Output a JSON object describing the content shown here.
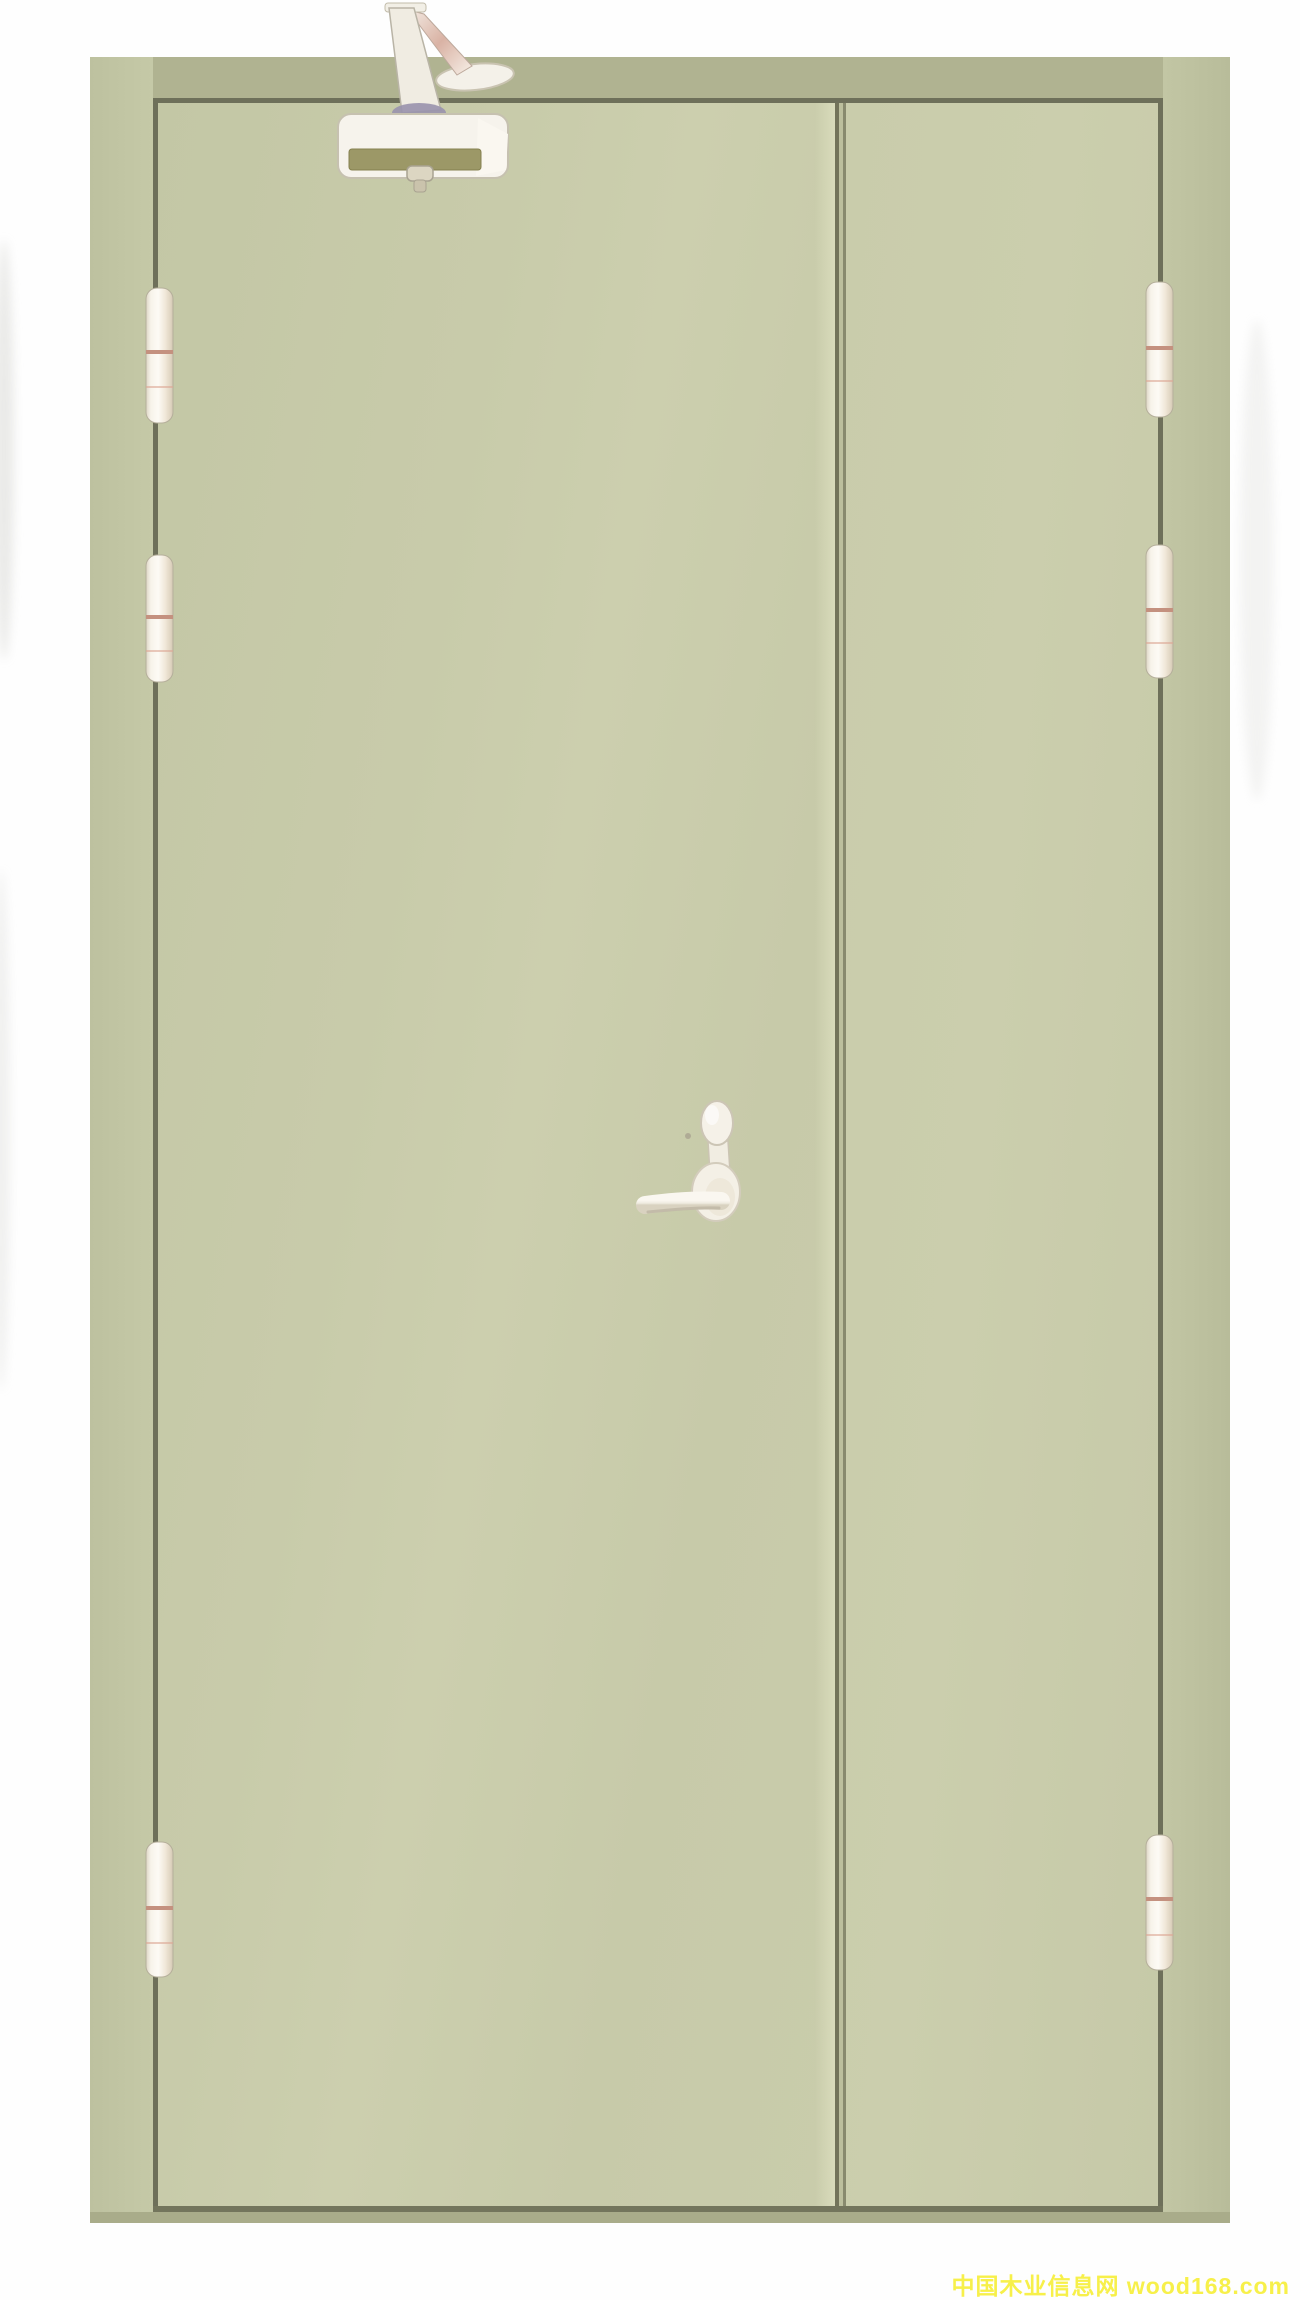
{
  "image": {
    "domain": "product-photograph",
    "subject": "Unequal double-leaf steel fire door, pale sage green, shown closed",
    "components": [
      "overhead door closer with folding arm",
      "lever handle with oval cylinder escutcheon",
      "six stainless barrel hinges (three per hinge stile)",
      "wide active leaf and narrow inactive leaf",
      "steel door frame"
    ],
    "hinge_count": 6
  },
  "watermark": {
    "text": "中国木业信息网 wood168.com",
    "color": "#f7f04a"
  },
  "colors": {
    "background": "#fefefe",
    "door_leaf_green": "#c8cbaa",
    "door_frame_green": "#bfc3a1",
    "frame_head_olive": "#b0b391",
    "outline_line": "#6e705a",
    "meeting_gap_dark": "#73745a",
    "hardware_white": "#f4f1e9",
    "closer_band_olive": "#9c9867",
    "closer_joint_violet": "#9992ad",
    "hinge_accent_pink": "#c4917f",
    "forearm_pink": "#d9b2a4"
  }
}
